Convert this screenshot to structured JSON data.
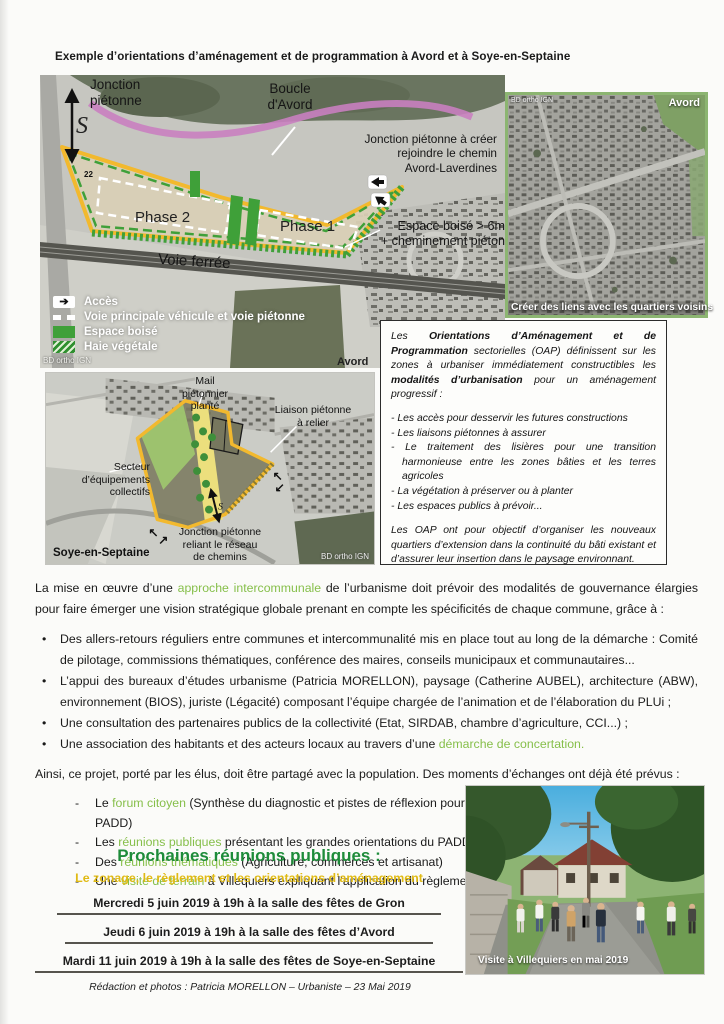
{
  "page": {
    "title": "Exemple d’orientations d’aménagement et de programmation à Avord et à Soye-en-Septaine"
  },
  "colors": {
    "heading_green": "#1e8c3a",
    "subtitle_yellow": "#e0ba14",
    "inline_green": "#86bf4a",
    "map_outline_yellow": "#f2b92e",
    "map_green": "#3fa039",
    "boucle_pink": "#c97fc0"
  },
  "avord_map": {
    "labels": {
      "jonction": [
        "Jonction",
        "piétonne"
      ],
      "s_symbol": "S",
      "n22": "22",
      "boucle": [
        "Boucle",
        "d'Avord"
      ],
      "jonction_creer": [
        "Jonction piétonne à créer",
        "rejoindre le chemin",
        "Avord-Laverdines"
      ],
      "phase2": "Phase 2",
      "phase1": "Phase 1",
      "espace_boise": [
        "Espace boisé > 6m",
        "+ cheminement piéton"
      ],
      "voie_ferree": "Voie ferrée",
      "corner": "Avord",
      "credit": "BD ortho IGN"
    },
    "legend": [
      {
        "icon": "arrow",
        "label": "Accès"
      },
      {
        "icon": "dash",
        "label": "Voie principale véhicule et voie piétonne"
      },
      {
        "icon": "green",
        "label": "Espace boisé"
      },
      {
        "icon": "hatch",
        "label": "Haie végétale"
      }
    ]
  },
  "avord_photo": {
    "credit": "BD ortho IGN",
    "name": "Avord",
    "caption": "Créer des liens avec les quartiers voisins"
  },
  "oap_box": {
    "intro": [
      {
        "t": "Les "
      },
      {
        "t": "Orientations d’Aménagement et de Programmation",
        "c": "b"
      },
      {
        "t": " sectorielles (OAP) définissent sur les zones à urbaniser immédiatement constructibles les "
      },
      {
        "t": "modalités d’urbanisation",
        "c": "b"
      },
      {
        "t": " pour un aménagement progressif :"
      }
    ],
    "items": [
      "Les accès pour desservir les futures constructions",
      "Les liaisons piétonnes à assurer",
      "Le traitement des lisières pour une transition harmonieuse entre les zones bâties et les terres agricoles",
      "La végétation à préserver ou à planter",
      "Les espaces publics à prévoir..."
    ],
    "outro": "Les OAP ont pour objectif d’organiser les nouveaux quartiers d’extension dans la continuité du bâti existant et d’assurer leur insertion dans le paysage environnant."
  },
  "soye_map": {
    "labels": {
      "mail": [
        "Mail",
        "piétonnier",
        "planté"
      ],
      "liaison": [
        "Liaison piétonne",
        "à relier"
      ],
      "secteur": [
        "Secteur d’équipements",
        "collectifs"
      ],
      "jonction": [
        "Jonction piétonne",
        "reliant le réseau",
        "de chemins"
      ],
      "name": "Soye-en-Septaine",
      "credit": "BD ortho IGN"
    }
  },
  "body": {
    "p1": [
      {
        "t": "La mise en œuvre d’une "
      },
      {
        "t": "approche intercommunale",
        "c": "g"
      },
      {
        "t": " de l’urbanisme doit prévoir des modalités de gouvernance élargies pour faire émerger une vision stratégique globale prenant en compte les spécificités de chaque commune, grâce à :"
      }
    ],
    "bullets": [
      [
        {
          "t": "Des allers-retours réguliers entre communes et intercommunalité mis en place tout au long de la démarche : Comité de pilotage, commissions thématiques, conférence des maires, conseils municipaux et communautaires..."
        }
      ],
      [
        {
          "t": "L’appui des bureaux d’études urbanisme (Patricia MORELLON), paysage (Catherine AUBEL), architecture (ABW), environnement (BIOS), juriste (Légacité) composant l’équipe chargée de l’animation et de l’élaboration du PLUi ;"
        }
      ],
      [
        {
          "t": "Une consultation des partenaires publics de la collectivité (Etat, SIRDAB, chambre d’agriculture, CCI...) ;"
        }
      ],
      [
        {
          "t": "Une association des habitants et des acteurs locaux au travers d’une "
        },
        {
          "t": "démarche de concertation.",
          "c": "g"
        }
      ]
    ],
    "p2": "Ainsi, ce projet, porté par les élus, doit être partagé avec la population. Des moments d’échanges ont déjà été prévus :",
    "dashes": [
      [
        {
          "t": "Le "
        },
        {
          "t": "forum citoyen",
          "c": "g"
        },
        {
          "t": " (Synthèse du diagnostic et pistes de réflexion pour le PADD)"
        }
      ],
      [
        {
          "t": "Les "
        },
        {
          "t": "réunions publiques",
          "c": "g"
        },
        {
          "t": " présentant les grandes orientations du PADD"
        }
      ],
      [
        {
          "t": "Des "
        },
        {
          "t": "réunions thématiques",
          "c": "g"
        },
        {
          "t": " (Agriculture, commerces et artisanat)"
        }
      ],
      [
        {
          "t": "Une "
        },
        {
          "t": "visite de terrain",
          "c": "g"
        },
        {
          "t": " à Villequiers expliquant l’application du règlement"
        }
      ]
    ]
  },
  "meetings": {
    "title": "Prochaines réunions publiques :",
    "subtitle": "Le zonage, le règlement et les orientations d’aménagement",
    "dates": [
      "Mercredi 5 juin 2019 à 19h à la salle des fêtes de Gron",
      "Jeudi 6 juin 2019 à 19h à la salle des fêtes d’Avord",
      "Mardi 11 juin 2019 à 19h à la salle des fêtes de Soye-en-Septaine"
    ]
  },
  "site_photo": {
    "caption": "Visite à Villequiers en mai 2019"
  },
  "footer": "Rédaction et photos : Patricia MORELLON – Urbaniste – 23 Mai 2019"
}
